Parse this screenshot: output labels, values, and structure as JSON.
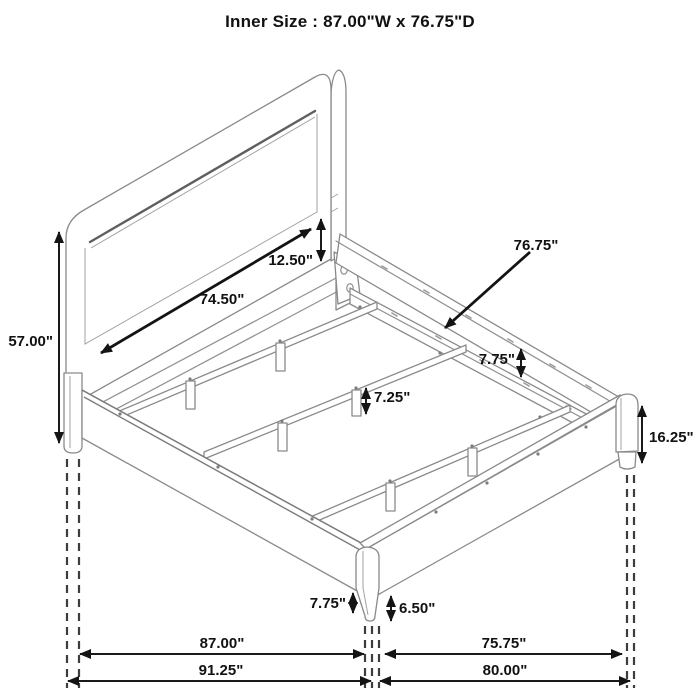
{
  "title": "Inner Size : 87.00\"W x 76.75\"D",
  "labels": {
    "headboard_height": "57.00\"",
    "panel_width": "74.50\"",
    "panel_to_rail_drop": "12.50\"",
    "inner_depth": "76.75\"",
    "rail_to_support_drop": "7.75\"",
    "center_leg_height": "7.25\"",
    "footboard_height": "16.25\"",
    "rail_floor_clearance": "7.75\"",
    "leg_exposed_height": "6.50\"",
    "inner_width": "87.00\"",
    "foot_inner_width": "75.75\"",
    "overall_width": "91.25\"",
    "foot_overall_width": "80.00\""
  },
  "colors": {
    "background": "#ffffff",
    "frame_line": "#8a8a8a",
    "seam_line": "#5f5f5f",
    "dimension": "#141414",
    "extension_dash": "#3d3d3d"
  }
}
